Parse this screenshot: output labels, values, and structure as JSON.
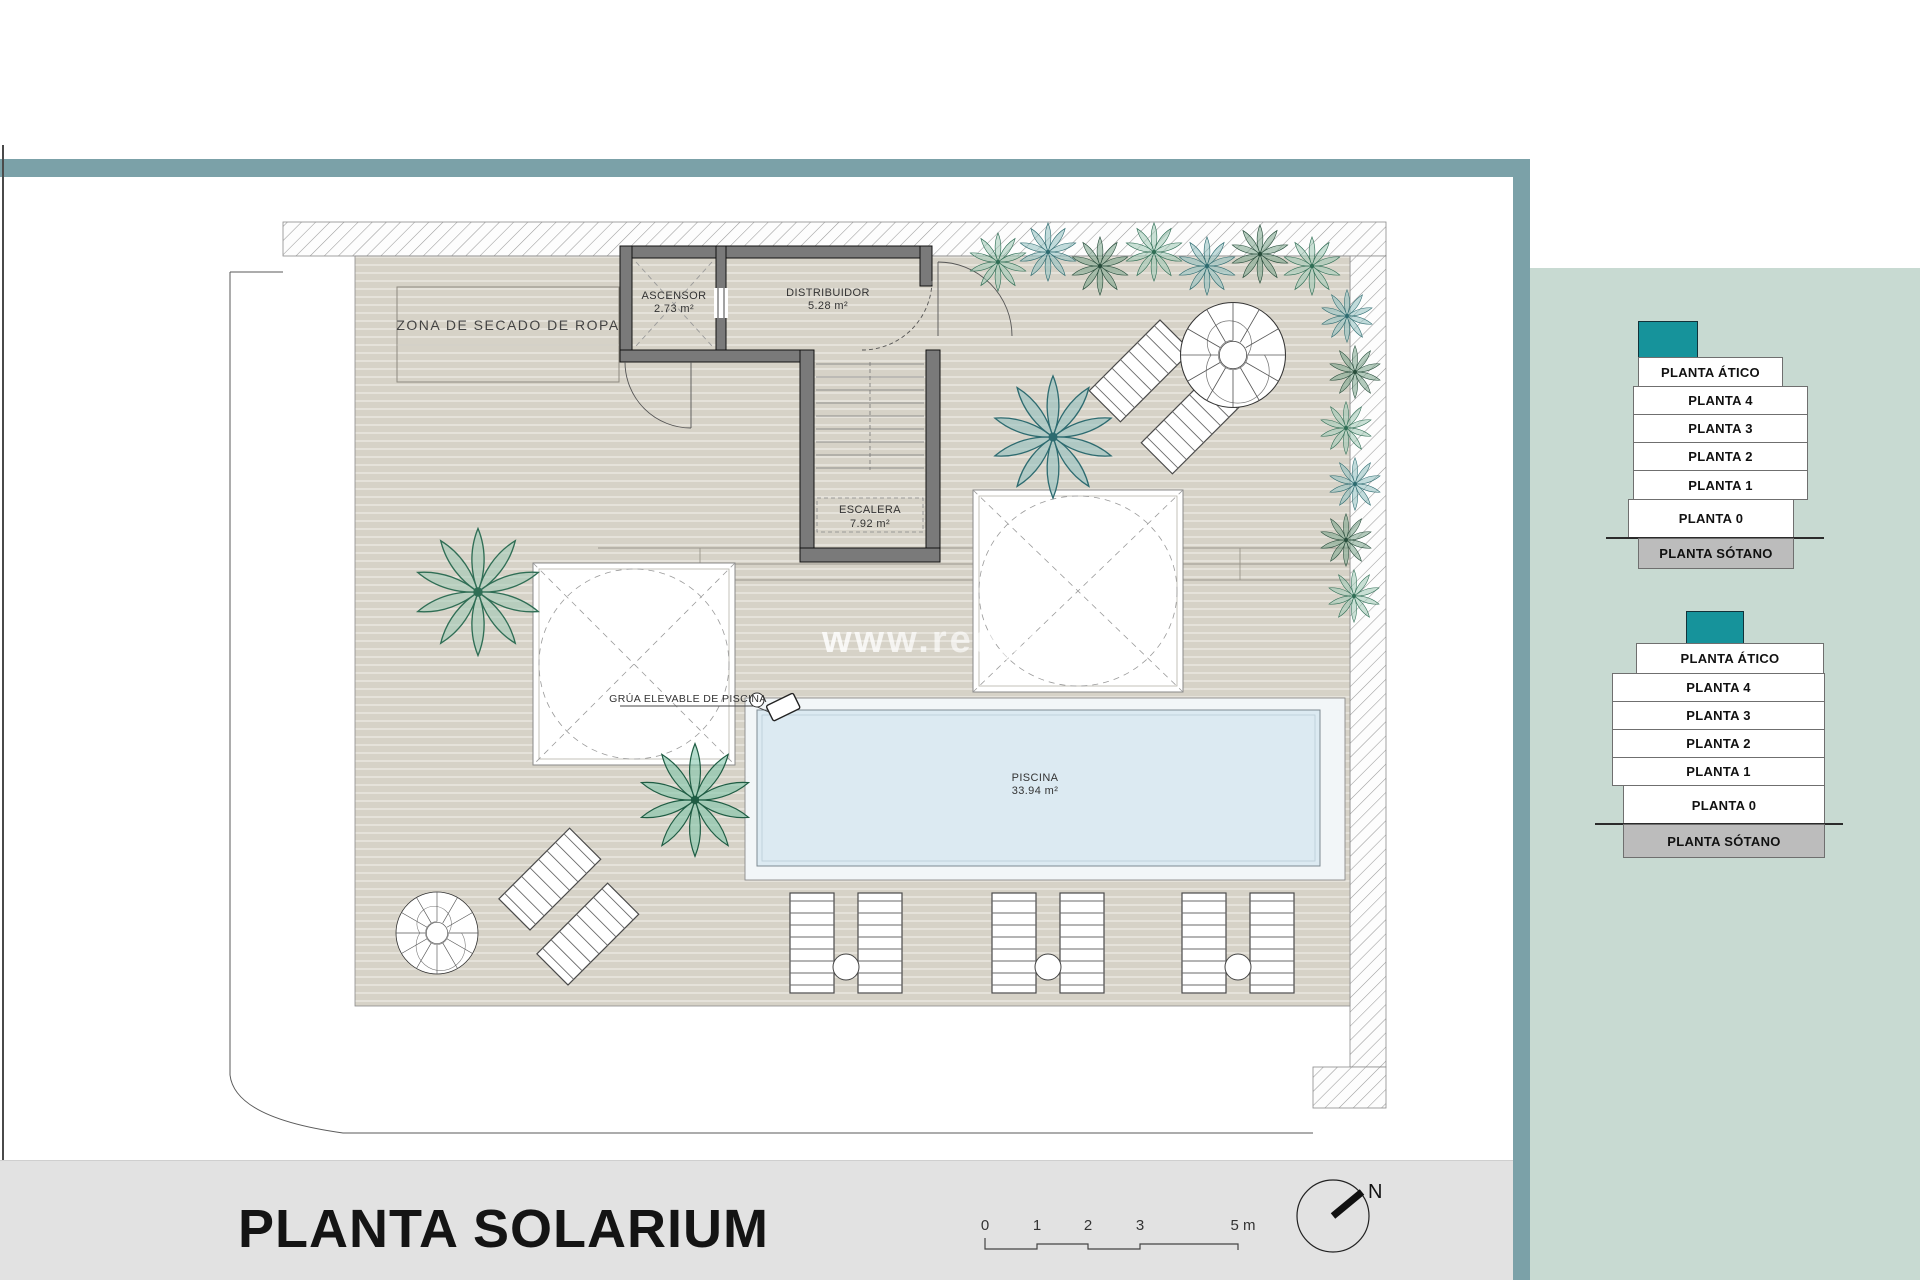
{
  "plan": {
    "zona_label": "ZONA DE SECADO DE ROPA",
    "ascensor_name": "ASCENSOR",
    "ascensor_area": "2.73 m²",
    "distribuidor_name": "DISTRIBUIDOR",
    "distribuidor_area": "5.28 m²",
    "escalera_name": "ESCALERA",
    "escalera_area": "7.92 m²",
    "piscina_name": "PISCINA",
    "piscina_area": "33.94 m²",
    "grua_label": "GRÚA ELEVABLE DE PISCINA",
    "watermark": "www.redpalm"
  },
  "footer": {
    "title": "PLANTA SOLARIUM",
    "scale_ticks": [
      "0",
      "1",
      "2",
      "3",
      "5 m"
    ],
    "north_label": "N"
  },
  "floor_stacks": [
    {
      "name": "stack-upper",
      "floors": [
        "PLANTA ÁTICO",
        "PLANTA 4",
        "PLANTA 3",
        "PLANTA 2",
        "PLANTA 1",
        "PLANTA 0",
        "PLANTA SÓTANO"
      ]
    },
    {
      "name": "stack-lower",
      "floors": [
        "PLANTA ÁTICO",
        "PLANTA 4",
        "PLANTA 3",
        "PLANTA 2",
        "PLANTA 1",
        "PLANTA 0",
        "PLANTA SÓTANO"
      ]
    }
  ],
  "colors": {
    "frame_teal": "#7ba1a8",
    "panel_sage": "#c8dad2",
    "highlight_teal": "#16939b",
    "basement_gray": "#bcbcbc",
    "pool_blue": "#dceaf2",
    "deck_beige": "#d6d2c7"
  }
}
